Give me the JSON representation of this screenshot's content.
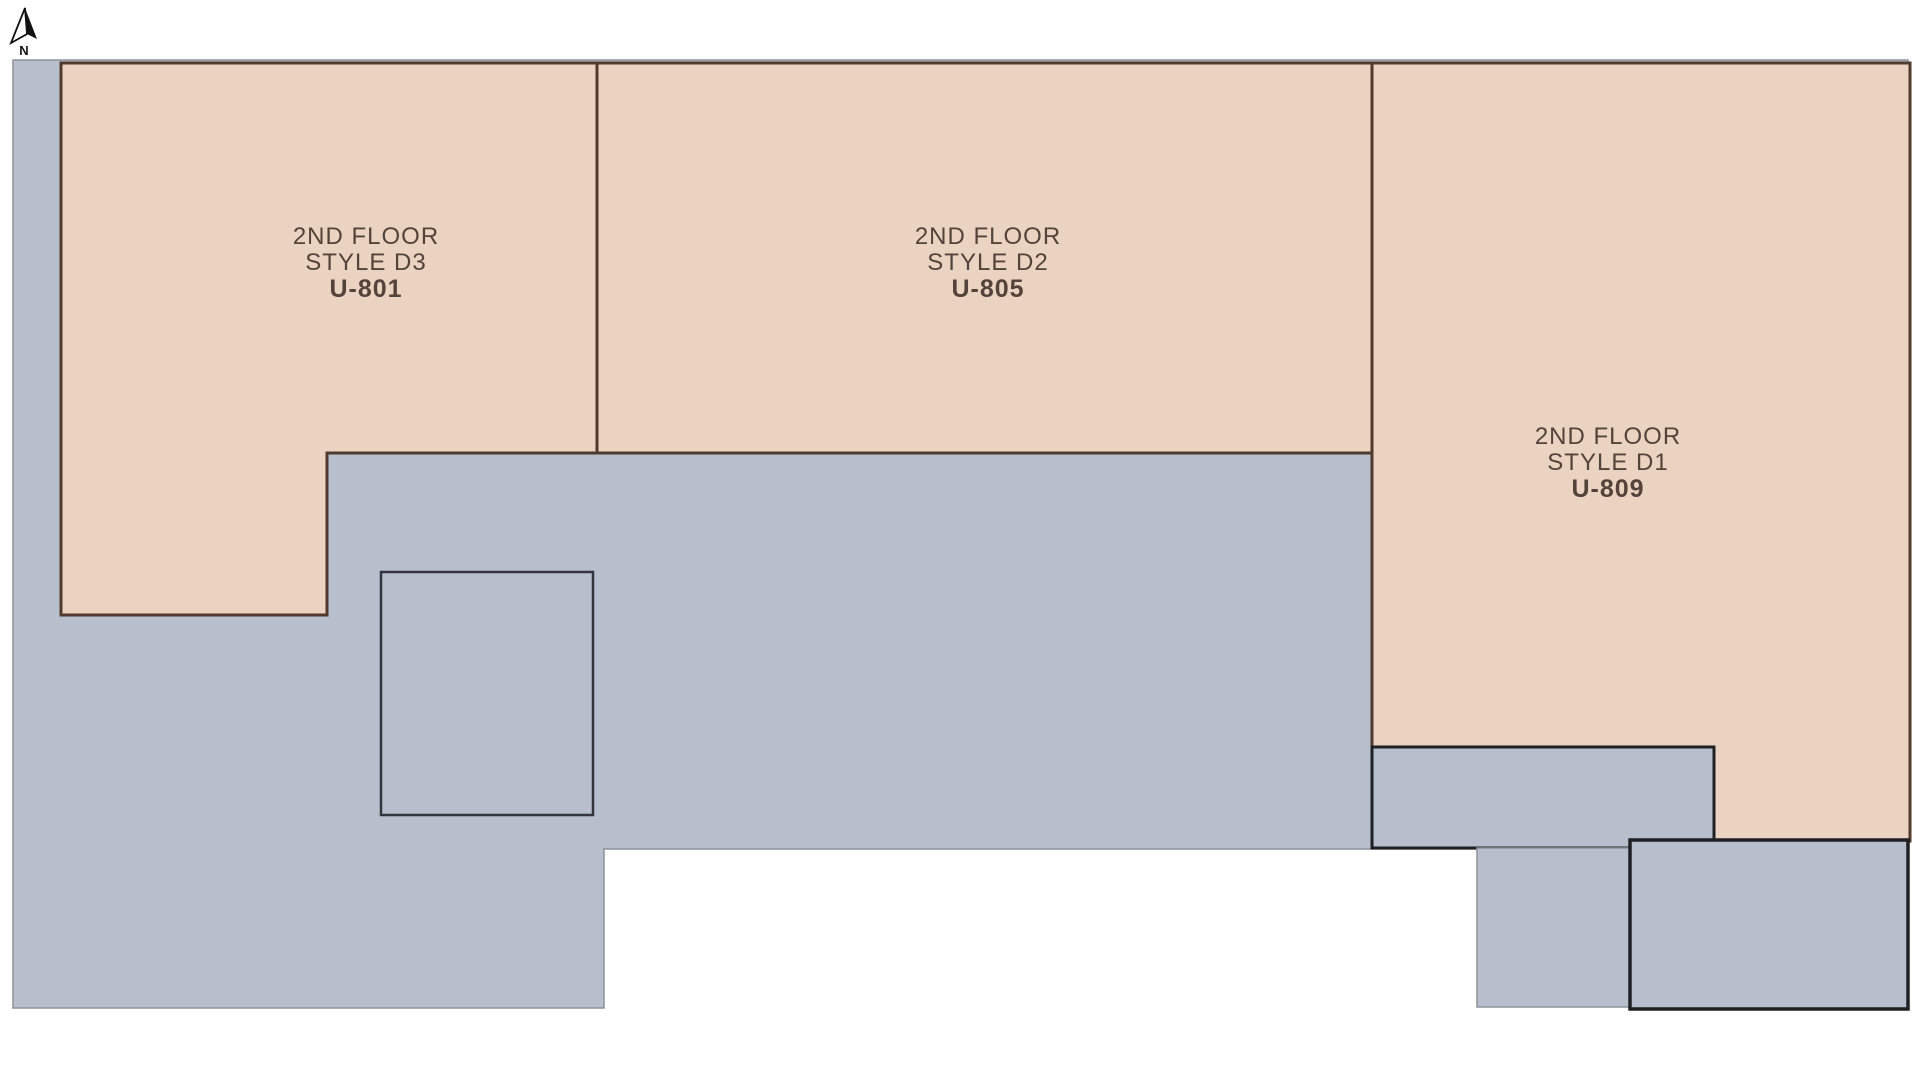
{
  "page": {
    "background": "#ffffff",
    "description_labels": {
      "compass_label": "N"
    }
  },
  "colors": {
    "unit_fill": "#ebd3c1",
    "unit_border": "#503a2e",
    "common_fill": "#b8bfcc",
    "common_border": "#8d929c",
    "dark_outline": "#1e2024",
    "inner_room_outline": "#33363c",
    "label_text": "#54433a",
    "compass_color": "#111111"
  },
  "compass": {
    "label": "N"
  },
  "units": [
    {
      "id": "U-801",
      "floor": "2ND FLOOR",
      "style": "STYLE D3",
      "number": "U-801"
    },
    {
      "id": "U-805",
      "floor": "2ND FLOOR",
      "style": "STYLE D2",
      "number": "U-805"
    },
    {
      "id": "U-809",
      "floor": "2ND FLOOR",
      "style": "STYLE D1",
      "number": "U-809"
    }
  ]
}
